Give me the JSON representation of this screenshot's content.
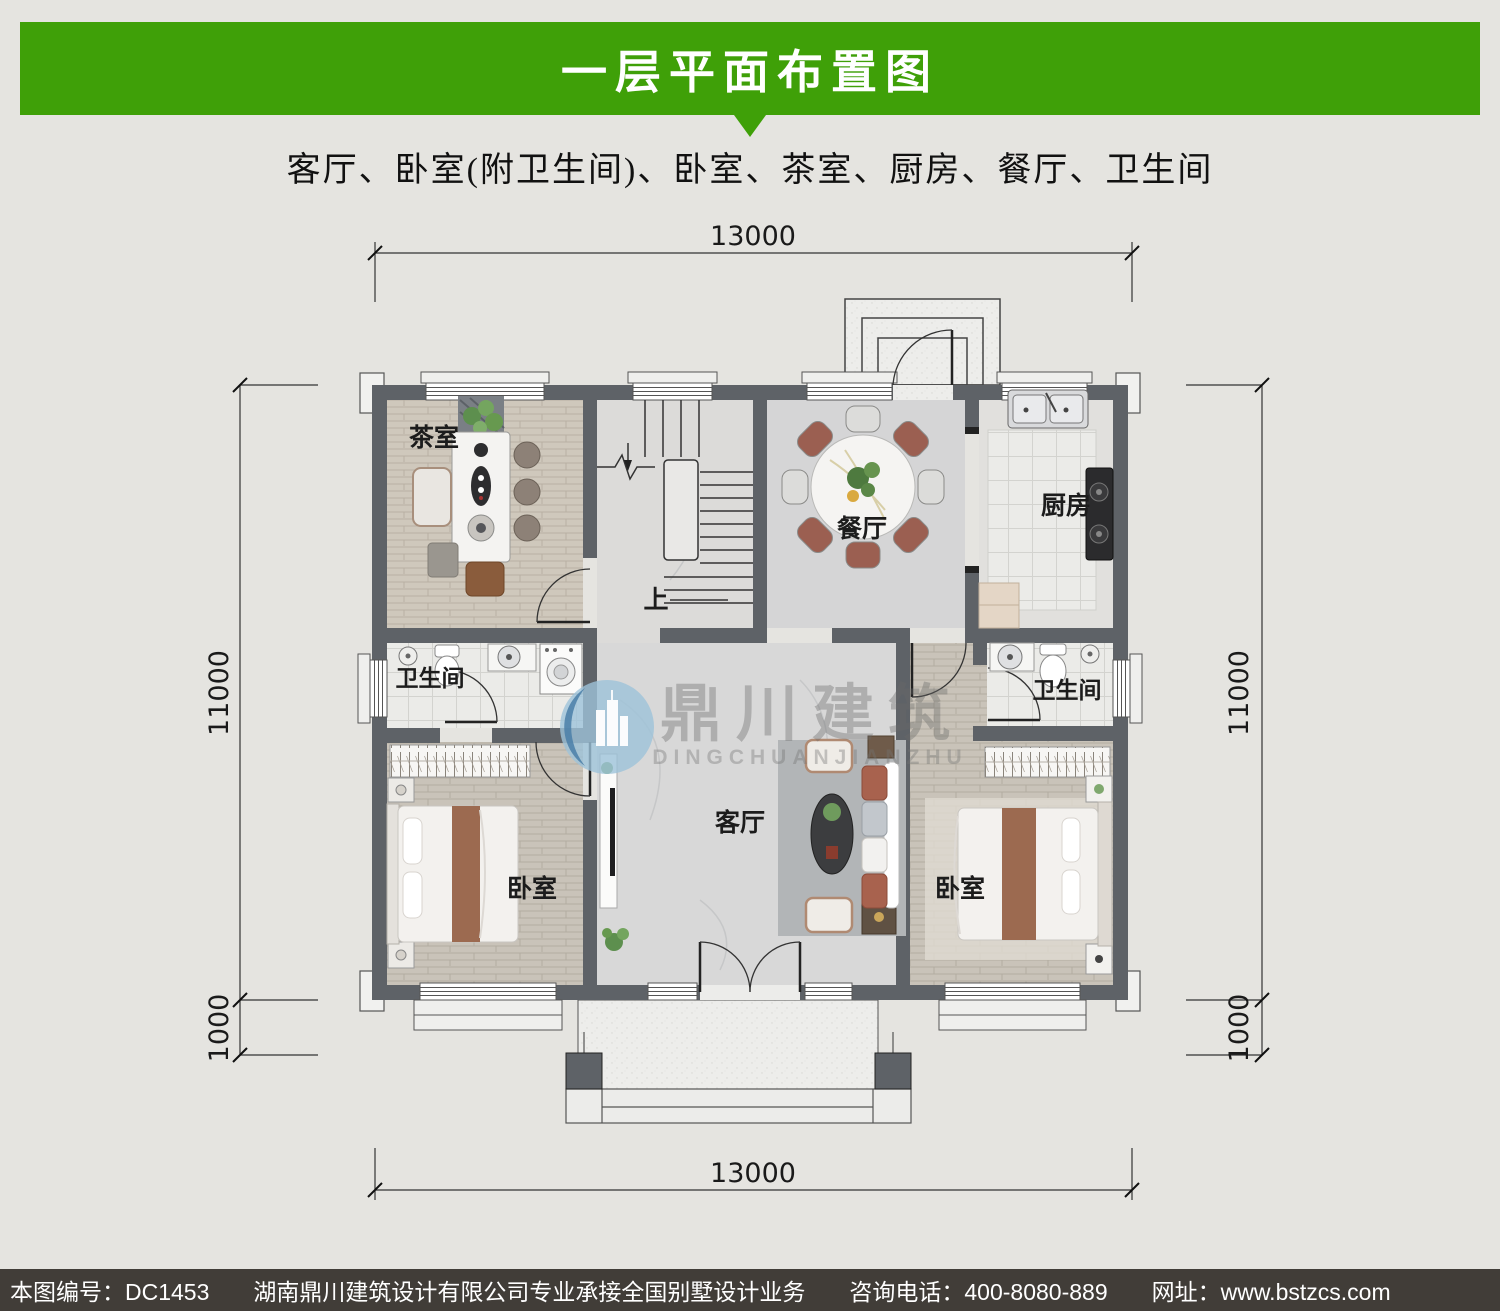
{
  "header": {
    "title": "一层平面布置图"
  },
  "subtitle": "客厅、卧室(附卫生间)、卧室、茶室、厨房、餐厅、卫生间",
  "rooms": {
    "tea_room": "茶室",
    "dining": "餐厅",
    "kitchen": "厨房",
    "bath_left": "卫生间",
    "bath_right": "卫生间",
    "living": "客厅",
    "bed_left": "卧室",
    "bed_right": "卧室",
    "stairs_up": "上"
  },
  "dimensions": {
    "top": "13000",
    "bottom": "13000",
    "left_main": "11000",
    "left_porch": "1000",
    "right_main": "11000",
    "right_porch": "1000"
  },
  "watermark": {
    "cn": "鼎川建筑",
    "en": "DINGCHUANJIANZHU"
  },
  "footer": {
    "plan_no": "本图编号：DC1453",
    "company": "湖南鼎川建筑设计有限公司专业承接全国别墅设计业务",
    "phone": "咨询电话：400-8080-889",
    "website": "网址：www.bstzcs.com"
  },
  "colors": {
    "accent_green": "#3fa008",
    "footer_bg": "#413d38",
    "wall": "#5e6267",
    "page_bg": "#e5e4e0"
  }
}
